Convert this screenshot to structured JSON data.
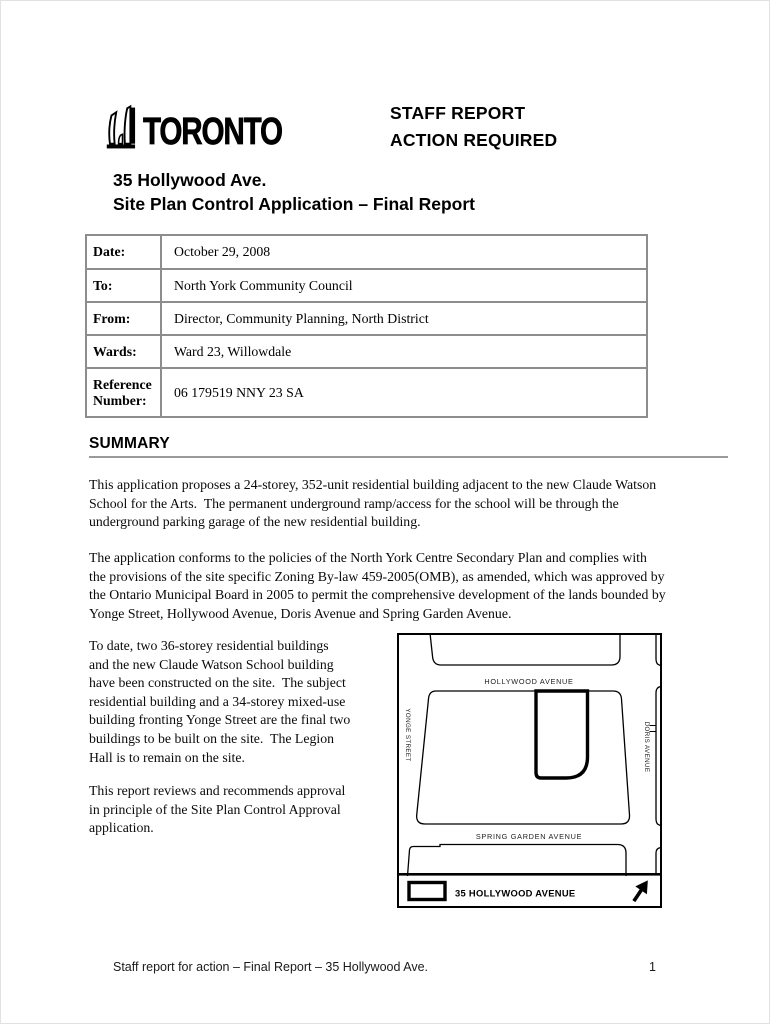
{
  "header": {
    "logo_wordmark": "TORONTO",
    "report_type_line1": "STAFF REPORT",
    "report_type_line2": "ACTION REQUIRED",
    "title_line1": "35 Hollywood Ave.",
    "title_line2": "Site Plan Control Application – Final Report"
  },
  "info_table": {
    "rows": [
      {
        "label": "Date:",
        "value": "October 29, 2008"
      },
      {
        "label": "To:",
        "value": "North York Community Council"
      },
      {
        "label": "From:",
        "value": "Director, Community Planning, North District"
      },
      {
        "label": "Wards:",
        "value": "Ward 23, Willowdale"
      },
      {
        "label": "Reference Number:",
        "value": "06 179519 NNY 23 SA"
      }
    ]
  },
  "summary": {
    "heading": "SUMMARY",
    "paragraph1": "This application proposes a 24-storey, 352-unit residential building adjacent to the new Claude Watson\nSchool for the Arts.  The permanent underground ramp/access for the school will be through the\nunderground parking garage of the new residential building.",
    "paragraph2": "The application conforms to the policies of the North York Centre Secondary Plan and complies with\nthe provisions of the site specific Zoning By-law 459-2005(OMB), as amended, which was approved by\nthe Ontario Municipal Board in 2005 to permit the comprehensive development of the lands bounded by\nYonge Street, Hollywood Avenue, Doris Avenue and Spring Garden Avenue.",
    "paragraph3": "To date, two 36-storey residential buildings\nand the new Claude Watson School building\nhave been constructed on the site.  The subject\nresidential building and a 34-storey mixed-use\nbuilding fronting Yonge Street are the final two\nbuildings to be built on the site.  The Legion\nHall is to remain on the site.",
    "paragraph4": "This report reviews and recommends approval\nin principle of the Site Plan Control Approval\napplication."
  },
  "map": {
    "street_top": "HOLLYWOOD AVENUE",
    "street_left": "YONGE STREET",
    "street_right": "DORIS AVENUE",
    "street_bottom": "SPRING GARDEN AVENUE",
    "legend_label": "35 HOLLYWOOD AVENUE",
    "line_color": "#000000"
  },
  "footer": {
    "text": "Staff report for action – Final Report – 35 Hollywood Ave.",
    "page_number": "1"
  }
}
